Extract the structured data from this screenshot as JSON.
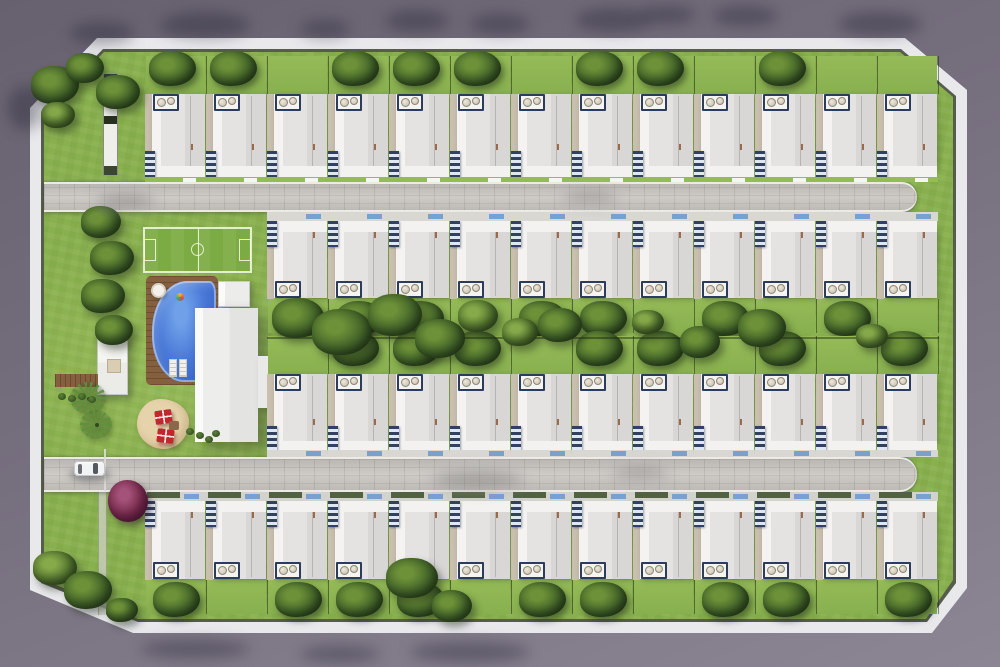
{
  "meta": {
    "subject": "aerial-render-residential-masterplan",
    "visible_text": "none",
    "total_house_units": 48
  },
  "palette": {
    "exterior_top": "#67616f",
    "exterior_bottom": "#8c8694",
    "sidewalk": "#e9e9ec",
    "wall": "#3c4431",
    "grass": "#88b04e",
    "grass_light": "#95bb58",
    "road": "#c9c6c1",
    "roof": "#e4e3e1",
    "roof_shade": "#d8d7d5",
    "porch": "#f3f2f0",
    "sidewall": "#c9bfae",
    "pergola_navy": "#31415f",
    "pergola_white": "#dfe7f2",
    "ac_frame": "#2c3c5c",
    "mat_blue": "#7aa0cc",
    "pool_blue": "#3e6ed2",
    "deck_brown": "#85603f",
    "field_green": "#7cab43",
    "tree_dark": "#2f4a22",
    "tree_mid": "#4c6e2d",
    "tree_light": "#6d9138",
    "sand": "#e6d3ab",
    "umbrella_red": "#c2272e",
    "purple_tree": "#7c2f4f",
    "car_body": "#f2f3f5",
    "car_glass": "#55585f"
  },
  "site": {
    "perimeter": {
      "shape": "chamfered-rectangle",
      "sidewalk_width_px": 11,
      "wall_line": true
    },
    "roads": [
      {
        "id": "road-north",
        "x": 44,
        "y": 182,
        "w": 873,
        "h": 30,
        "rounded_end": "right",
        "surface": "pavers"
      },
      {
        "id": "road-south",
        "x": 44,
        "y": 457,
        "w": 873,
        "h": 35,
        "rounded_end": "right",
        "surface": "pavers"
      }
    ],
    "house_rows": [
      {
        "id": "row-north",
        "count": 13,
        "orientation": "down",
        "x": 145,
        "y": 56,
        "lot_w": 61,
        "h": 126,
        "trees": [
          1,
          1,
          0,
          1,
          1,
          1,
          0,
          1,
          1,
          0,
          1,
          0,
          0
        ]
      },
      {
        "id": "row-center-north",
        "count": 11,
        "orientation": "up",
        "x": 267,
        "y": 212,
        "lot_w": 61,
        "h": 121,
        "trees": [
          1,
          1,
          1,
          0,
          1,
          1,
          0,
          1,
          0,
          1,
          0
        ]
      },
      {
        "id": "row-center-south",
        "count": 11,
        "orientation": "down",
        "x": 267,
        "y": 336,
        "lot_w": 61,
        "h": 121,
        "trees": [
          0,
          1,
          1,
          1,
          0,
          1,
          1,
          0,
          1,
          0,
          1
        ]
      },
      {
        "id": "row-south",
        "count": 13,
        "orientation": "up",
        "x": 145,
        "y": 492,
        "lot_w": 61,
        "h": 122,
        "trees": [
          1,
          0,
          1,
          1,
          1,
          0,
          1,
          1,
          0,
          1,
          1,
          0,
          1
        ]
      }
    ],
    "house_features": [
      "white-flat-roof",
      "rooftop-ac-pair",
      "navy-louvered-pergola",
      "blue-doormat",
      "private-backyard"
    ],
    "amenities": [
      "mini-soccer-field",
      "swimming-pool",
      "pool-deck",
      "round-daybed",
      "pool-float",
      "sun-loungers",
      "clubhouse",
      "clubhouse-annex",
      "gym-pavilion",
      "boardwalk",
      "kids-sand-patio",
      "red-umbrellas",
      "palm-trees",
      "purple-flowering-tree",
      "entry-gate-wall",
      "walk-path"
    ],
    "car": {
      "x": 74,
      "y": 461,
      "color": "white",
      "heading": "east"
    },
    "trees": [
      {
        "x": 55,
        "y": 85,
        "r": 24
      },
      {
        "x": 85,
        "y": 68,
        "r": 19
      },
      {
        "x": 118,
        "y": 92,
        "r": 22
      },
      {
        "x": 58,
        "y": 115,
        "r": 17,
        "tone": "mid"
      },
      {
        "x": 101,
        "y": 222,
        "r": 20
      },
      {
        "x": 112,
        "y": 258,
        "r": 22
      },
      {
        "x": 103,
        "y": 296,
        "r": 22
      },
      {
        "x": 114,
        "y": 330,
        "r": 19
      },
      {
        "x": 55,
        "y": 568,
        "r": 22,
        "tone": "mid"
      },
      {
        "x": 88,
        "y": 590,
        "r": 24
      },
      {
        "x": 122,
        "y": 610,
        "r": 16
      },
      {
        "x": 412,
        "y": 578,
        "r": 26
      },
      {
        "x": 452,
        "y": 606,
        "r": 20
      },
      {
        "x": 298,
        "y": 318,
        "r": 26
      },
      {
        "x": 342,
        "y": 332,
        "r": 30
      },
      {
        "x": 395,
        "y": 315,
        "r": 27
      },
      {
        "x": 440,
        "y": 338,
        "r": 25
      },
      {
        "x": 478,
        "y": 316,
        "r": 20,
        "tone": "mid"
      },
      {
        "x": 520,
        "y": 332,
        "r": 18,
        "tone": "mid"
      },
      {
        "x": 560,
        "y": 325,
        "r": 22
      },
      {
        "x": 648,
        "y": 322,
        "r": 16,
        "tone": "mid"
      },
      {
        "x": 700,
        "y": 342,
        "r": 20
      },
      {
        "x": 762,
        "y": 328,
        "r": 24
      },
      {
        "x": 872,
        "y": 336,
        "r": 16,
        "tone": "mid"
      }
    ],
    "shadows": [
      {
        "x": 70,
        "y": 22,
        "w": 64,
        "h": 22
      },
      {
        "x": 160,
        "y": 12,
        "w": 90,
        "h": 26
      },
      {
        "x": 300,
        "y": 20,
        "w": 50,
        "h": 18
      },
      {
        "x": 385,
        "y": 10,
        "w": 64,
        "h": 22
      },
      {
        "x": 470,
        "y": 14,
        "w": 60,
        "h": 20
      },
      {
        "x": 575,
        "y": 8,
        "w": 76,
        "h": 24
      },
      {
        "x": 640,
        "y": 6,
        "w": 56,
        "h": 18
      },
      {
        "x": 712,
        "y": 6,
        "w": 66,
        "h": 20
      },
      {
        "x": 838,
        "y": 12,
        "w": 84,
        "h": 24
      },
      {
        "x": 8,
        "y": 86,
        "w": 34,
        "h": 44
      },
      {
        "x": 140,
        "y": 640,
        "w": 110,
        "h": 18
      },
      {
        "x": 300,
        "y": 646,
        "w": 80,
        "h": 16
      },
      {
        "x": 410,
        "y": 642,
        "w": 120,
        "h": 20
      },
      {
        "x": 430,
        "y": 468,
        "w": 95,
        "h": 22,
        "on": "road"
      },
      {
        "x": 610,
        "y": 464,
        "w": 60,
        "h": 16,
        "on": "road"
      },
      {
        "x": 560,
        "y": 188,
        "w": 60,
        "h": 16,
        "on": "road"
      },
      {
        "x": 95,
        "y": 190,
        "w": 60,
        "h": 20,
        "on": "road"
      }
    ],
    "shrubs": [
      {
        "x": 58,
        "y": 393
      },
      {
        "x": 68,
        "y": 395
      },
      {
        "x": 78,
        "y": 393
      },
      {
        "x": 88,
        "y": 396
      },
      {
        "x": 186,
        "y": 428
      },
      {
        "x": 196,
        "y": 432
      },
      {
        "x": 205,
        "y": 436
      },
      {
        "x": 212,
        "y": 430
      }
    ]
  }
}
